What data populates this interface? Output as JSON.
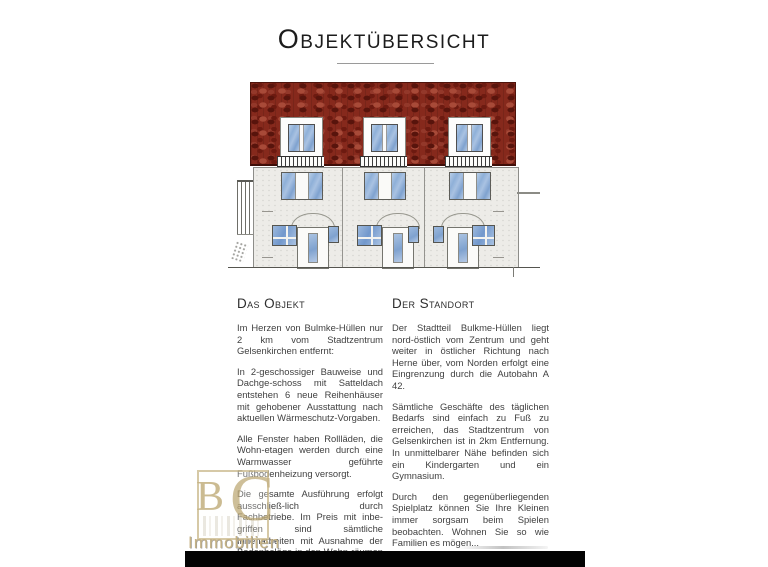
{
  "title": "Objektübersicht",
  "sections": {
    "left": {
      "heading": "Das Objekt",
      "paragraphs": [
        "Im Herzen von Bulmke-Hüllen nur 2 km vom Stadtzentrum Gelsenkirchen entfernt:",
        "In 2-geschossiger Bauweise und Dachge-schoss mit Satteldach entstehen 6 neue Reihenhäuser mit gehobener Ausstattung nach aktuellen Wärmeschutz-Vorgaben.",
        "Alle Fenster haben Rollläden, die Wohn-etagen werden durch eine Warmwasser geführte Fußbodenheizung versorgt.",
        "Die gesamte Ausführung erfolgt ausschließ-lich durch Fachbetriebe. Im Preis mit inbe-griffen sind sämtliche Innenarbeiten mit Ausnahme der Bodenbeläge in den Wohn-räumen und den Maler- und Lackierarbeiten."
      ]
    },
    "right": {
      "heading": "Der Standort",
      "paragraphs": [
        "Der Stadtteil Bulkme-Hüllen liegt nord-östlich vom Zentrum und geht weiter in östlicher Richtung nach Herne über, vom Norden erfolgt eine Eingrenzung durch die Autobahn A 42.",
        "Sämtliche Geschäfte des täglichen Bedarfs sind einfach zu Fuß zu erreichen, das Stadtzentrum von Gelsenkirchen ist in 2km Entfernung. In unmittelbarer Nähe befinden sich ein Kindergarten und ein Gymnasium.",
        "Durch den gegenüberliegenden Spielplatz können Sie Ihre Kleinen immer sorgsam beim Spielen beobachten. Wohnen Sie so wie Familien es mögen..."
      ]
    }
  },
  "watermark": {
    "monogram_b": "B",
    "monogram_c": "C",
    "label": "Immobilien"
  },
  "colors": {
    "roof_red": "#86291c",
    "facade_gray": "#edece8",
    "window_blue": "#8fb0d8",
    "logo_gold": "#c6b284",
    "bottom_bar": "#030303"
  }
}
